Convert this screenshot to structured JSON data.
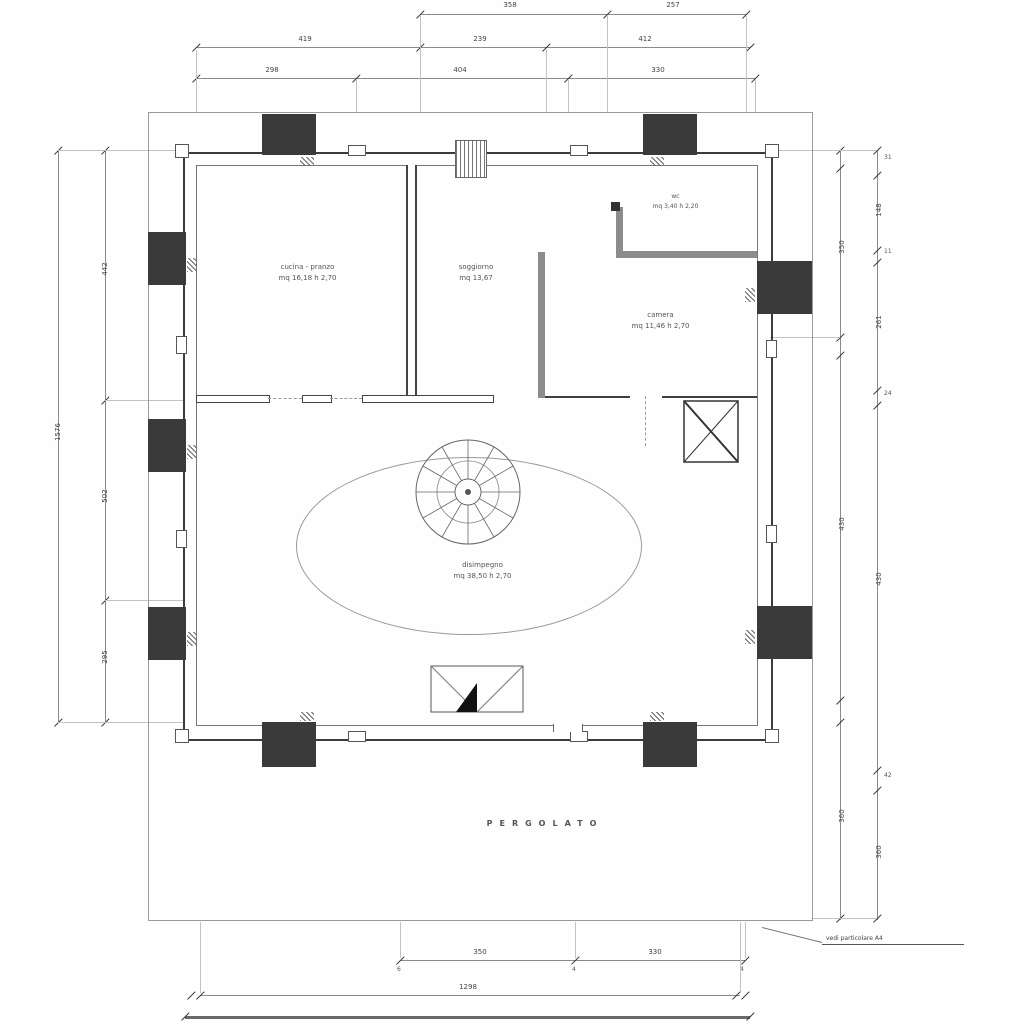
{
  "rooms": {
    "kitchen": {
      "line1": "cucina - pranzo",
      "line2": "mq 16,18  h 2,70"
    },
    "living": {
      "line1": "soggiorno",
      "line2": "mq 13,67"
    },
    "bedroom": {
      "line1": "camera",
      "line2": "mq 11,46  h 2,70"
    },
    "wc": {
      "line1": "wc",
      "line2": "mq 3,40  h 2,20"
    },
    "hall": {
      "line1": "disimpegno",
      "line2": "mq 38,50  h 2,70"
    },
    "pergolato": "PERGOLATO"
  },
  "note": {
    "text": "vedi particolare A4"
  },
  "dims": {
    "t1a": "358",
    "t1b": "257",
    "t2a": "419",
    "t2b": "239",
    "t2c": "412",
    "t3a": "298",
    "t3b": "404",
    "t3c": "330",
    "l1": "1576",
    "l2a": "442",
    "l2b": "502",
    "l2c": "295",
    "r1a": "350",
    "r1b": "430",
    "r1c": "360",
    "r2a": "31",
    "r2b": "148",
    "r2c": "11",
    "r2d": "261",
    "r2e": "24",
    "r2f": "430",
    "r2g": "42",
    "r2h": "360",
    "b1a": "350",
    "b1b": "330",
    "b1s1": "6",
    "b1s2": "4",
    "b1s3": "4",
    "b2": "1298"
  },
  "colors": {
    "line": "#8a8a8a",
    "wall": "#3a3a3a",
    "graywall": "#8c8c8c"
  }
}
